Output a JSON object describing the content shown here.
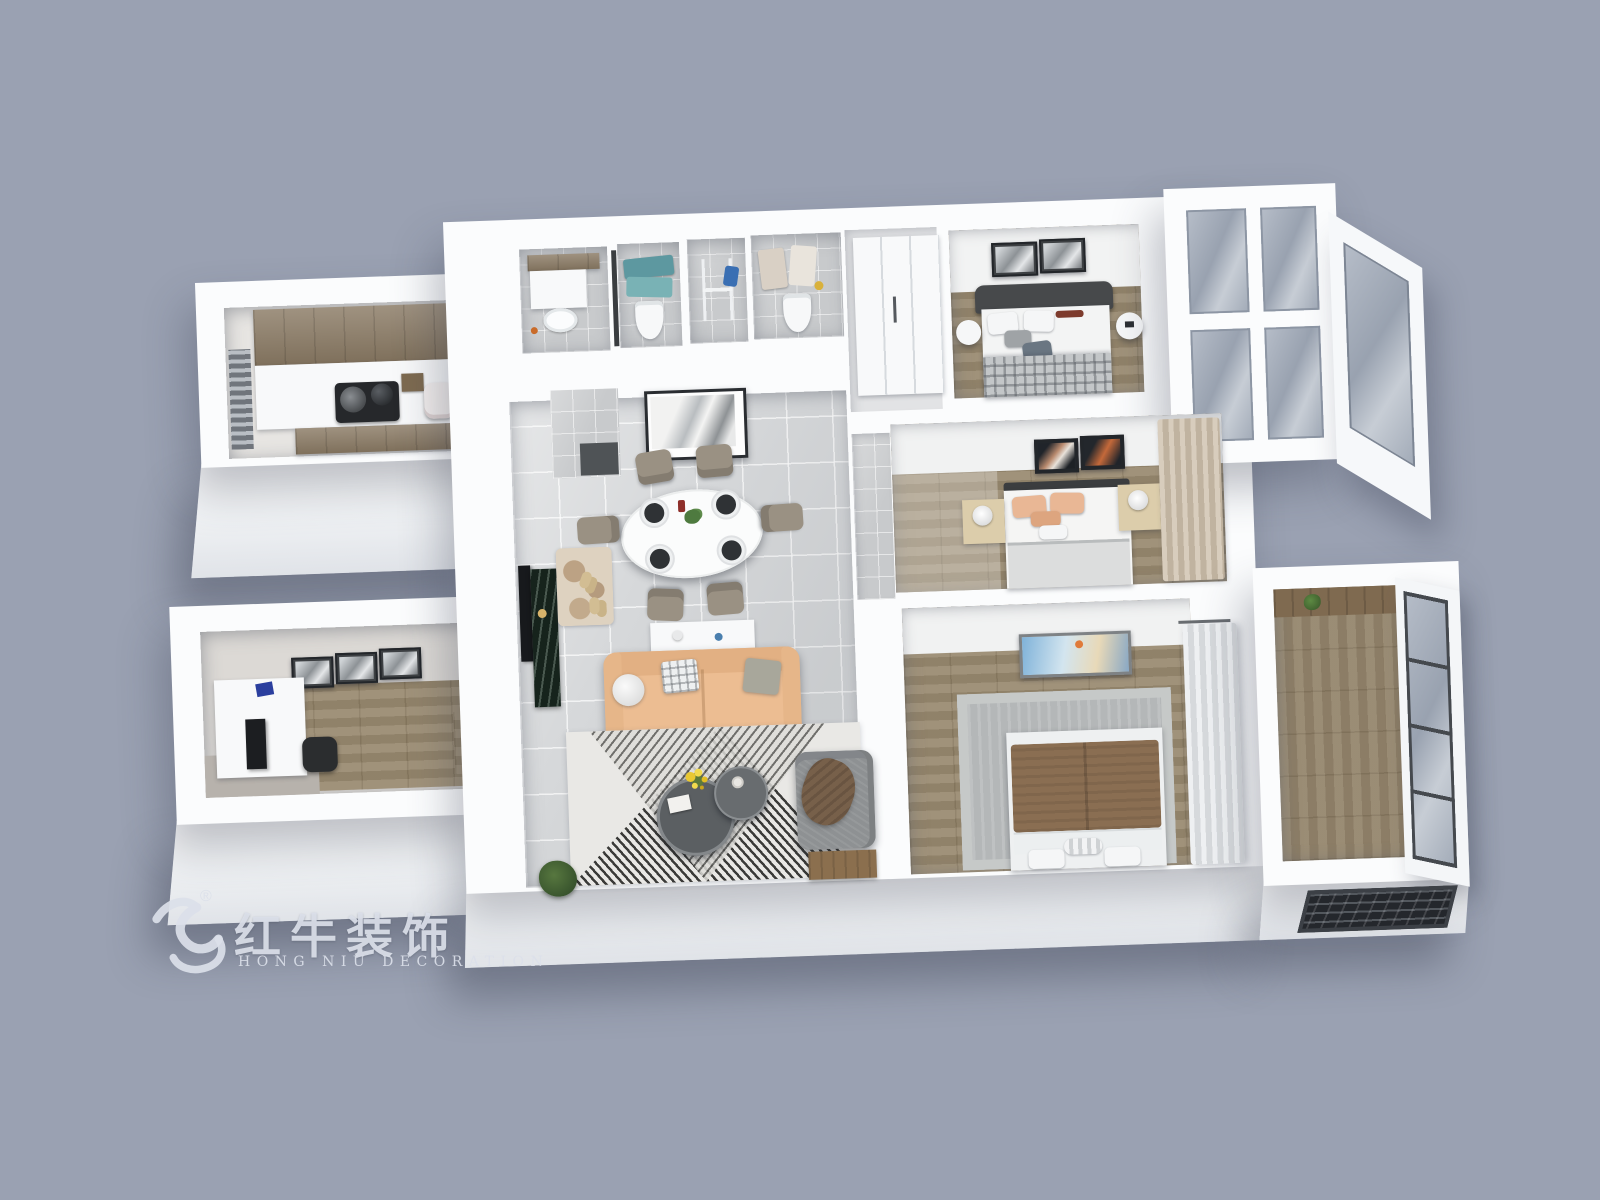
{
  "scene": {
    "description": "3D axonometric floor-plan rendering of a three-bedroom apartment",
    "background_color": "#9aa1b2"
  },
  "watermark": {
    "brand_cn": "红牛装饰",
    "brand_en": "HONG NIU DECORATION",
    "registered": "®",
    "logo": "bull-swoosh",
    "color": "#dbe0e9"
  },
  "palette": {
    "wall_white": "#fbfcfd",
    "wall_shade": "#e0e3e8",
    "tile_floor": "#d6d8da",
    "bath_tile": "#c8cacc",
    "wood_floor": "#98896f",
    "cabinet_wood": "#8a7a64",
    "sofa_peach": "#ecbd92",
    "armchair_gray": "#8e9193",
    "towel_teal": "#5d98a0",
    "blanket_brown": "#8a6e52",
    "rug_stripe_dark": "#3a3a38",
    "glass_blue": "#a6afbc"
  },
  "rooms": [
    {
      "name": "kitchen",
      "position": "north-west wing",
      "items": [
        "wood wall cabinets",
        "white counter",
        "black cooktop with pans",
        "rice cooker",
        "spice rack",
        "window"
      ]
    },
    {
      "name": "bathrooms",
      "position": "north strip",
      "items": [
        "vanity with wood mirror cabinet",
        "toilet",
        "teal towels on rack",
        "laundry bay with drying rack",
        "second toilet with hanging towels",
        "dark glass partition"
      ]
    },
    {
      "name": "north-corridor",
      "position": "center-north",
      "items": [
        "white wardrobe"
      ]
    },
    {
      "name": "bedroom-north",
      "position": "north-east",
      "items": [
        "double bed with dark headboard",
        "plaid blanket",
        "two wall pictures",
        "round bedside tables",
        "wood floor"
      ]
    },
    {
      "name": "bedroom-middle",
      "position": "east",
      "items": [
        "double bed",
        "peach pillows",
        "two dark wall pictures",
        "light-wood nightstands with white lamps",
        "beige curtains"
      ]
    },
    {
      "name": "master-bedroom",
      "position": "south-east",
      "items": [
        "double bed with brown duvet",
        "gray area rug",
        "hot-air-balloon painting",
        "sheer white curtains"
      ]
    },
    {
      "name": "living-dining",
      "position": "center",
      "items": [
        "oval dining table with place settings",
        "six taupe dining chairs",
        "abstract wall art",
        "peach leather sofa with cushions",
        "white console table",
        "round nesting coffee tables",
        "yellow flowers",
        "gray armchair with brown throw",
        "black-and-white geometric rug",
        "dark marble TV cabinet with TV",
        "entry rug with slippers",
        "green plant",
        "wood bench"
      ]
    },
    {
      "name": "study",
      "position": "south-west wing",
      "items": [
        "white desk",
        "monitor",
        "black office chair",
        "three wall pictures",
        "wood floor",
        "gray mat"
      ]
    },
    {
      "name": "balcony-north-east",
      "items": [
        "white window frames",
        "blue-gray glass panes",
        "slanted east window wall"
      ]
    },
    {
      "name": "balcony-south-east",
      "items": [
        "wood floor",
        "wood shelf with plant",
        "metal-framed window wall",
        "louvered front window"
      ]
    }
  ]
}
